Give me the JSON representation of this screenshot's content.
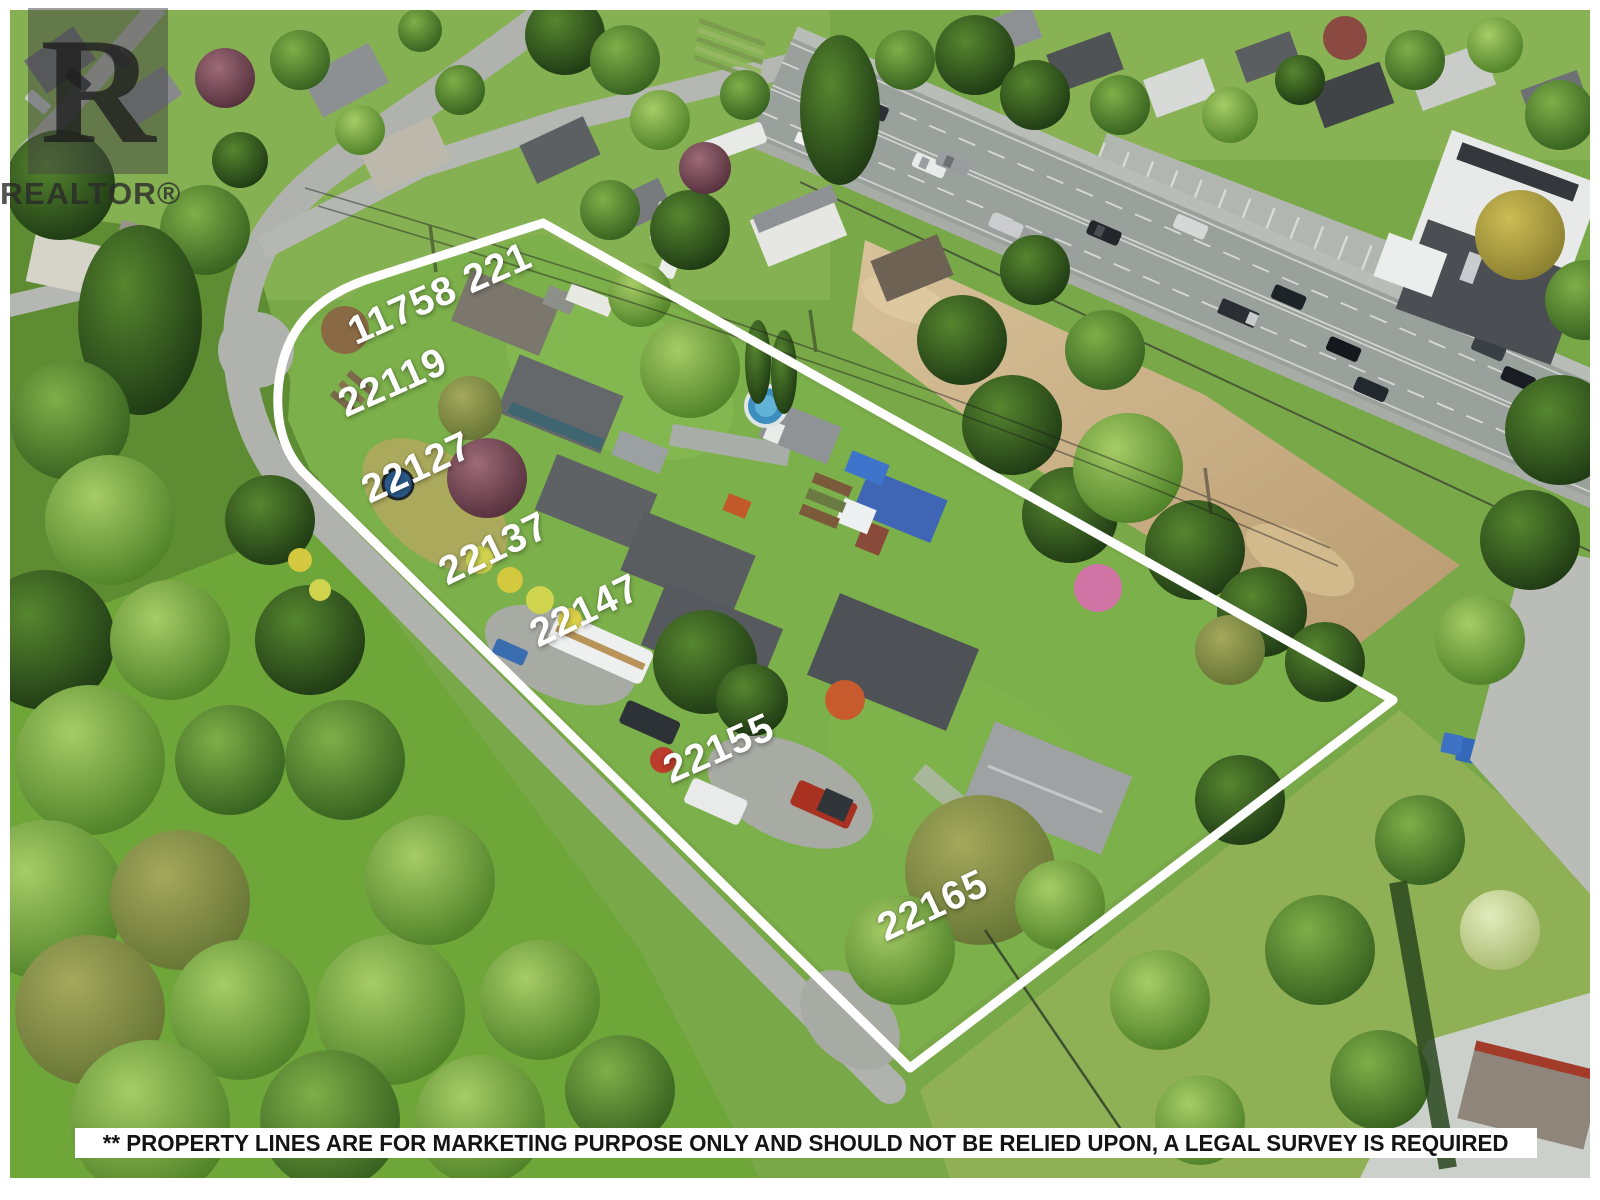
{
  "watermark": {
    "logo_letter": "R",
    "brand": "REALTOR®"
  },
  "labels": [
    {
      "text": "11758 221",
      "x": 440,
      "y": 294,
      "rot": -24
    },
    {
      "text": "22119",
      "x": 393,
      "y": 383,
      "rot": -24
    },
    {
      "text": "22127",
      "x": 417,
      "y": 468,
      "rot": -25
    },
    {
      "text": "22137",
      "x": 494,
      "y": 549,
      "rot": -26
    },
    {
      "text": "22147",
      "x": 585,
      "y": 611,
      "rot": -26
    },
    {
      "text": "22155",
      "x": 719,
      "y": 749,
      "rot": -24
    },
    {
      "text": "22165",
      "x": 933,
      "y": 906,
      "rot": -25
    }
  ],
  "disclaimer": {
    "text": "** PROPERTY LINES ARE FOR MARKETING PURPOSE ONLY AND SHOULD NOT BE RELIED UPON, A LEGAL SURVEY IS REQUIRED"
  },
  "palette": {
    "property_line": "#ffffff",
    "label_text": "#ffffff",
    "banner_bg": "#ffffff",
    "banner_text": "#141414",
    "grass": "#79a848",
    "road": "#b4b7b2",
    "highway": "#9aa19c",
    "parking": "#b2b6b1",
    "dirt": "#c7ad84",
    "pool_blue": "#3e8fc0",
    "tarp_blue": "#3f74cc",
    "roof_dark": "#54585c",
    "roof_light": "#9fa2a3"
  }
}
